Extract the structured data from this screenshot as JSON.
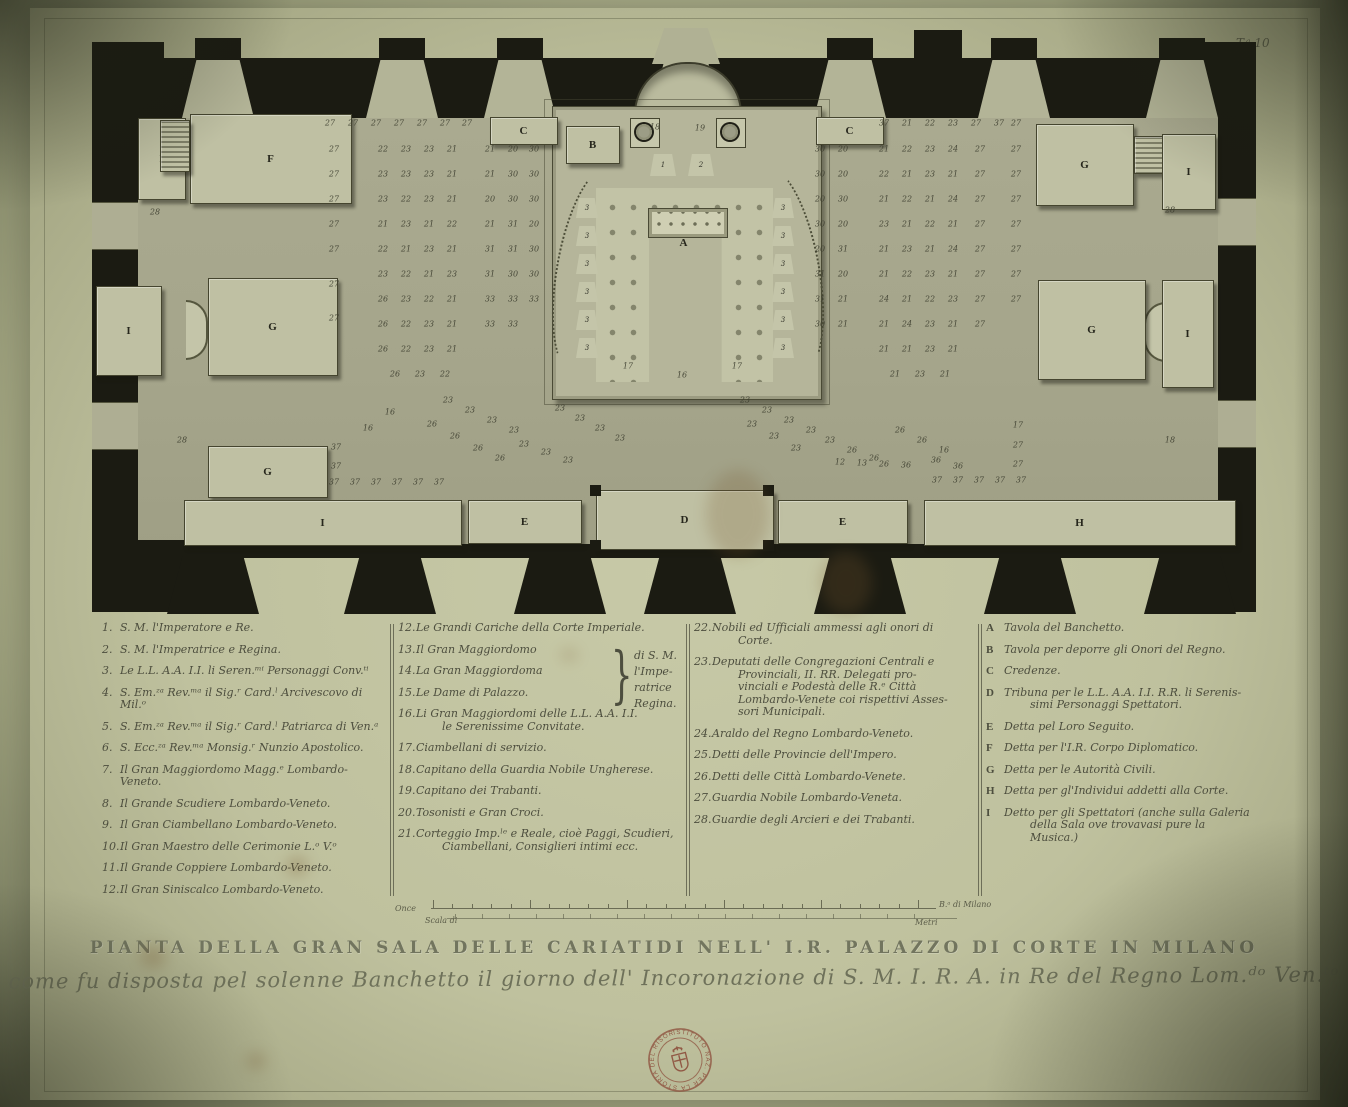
{
  "plate_number": "T.ᵃ 10",
  "title": "PIANTA DELLA GRAN SALA DELLE CARIATIDI NELL' I.R. PALAZZO DI CORTE IN MILANO",
  "subtitle": "come fu disposta pel solenne Banchetto il giorno dell' Incoronazione di S. M. I. R. A. in Re del Regno Lom.ᵈᵒ Ven.ᵗᵒ",
  "stamp": {
    "ring_text": "ISTITUTO NAZ. PER LA STORIA DEL RISORGIMENTO · ROMA ·",
    "color": "#8d4f3c"
  },
  "scale_bar": {
    "label_once": "Once",
    "label_scala": "Scala di",
    "label_braccia": "B.ᵃ di Milano",
    "label_metri": "Metri",
    "ticks_upper": 26,
    "ticks_lower": 18
  },
  "legend": {
    "columns": [
      {
        "x": 0,
        "width": 284,
        "items": [
          {
            "k": "1.",
            "t": "S. M. l'Imperatore e Re."
          },
          {
            "k": "2.",
            "t": "S. M. l'Imperatrice e Regina."
          },
          {
            "k": "3.",
            "t": "Le L.L. A.A. I.I. li Seren.ᵐⁱ Personaggi Conv.ᵗⁱ"
          },
          {
            "k": "4.",
            "t": "S. Em.ᶻᵃ Rev.ᵐᵃ il Sig.ʳ Card.ˡ Arcivescovo di Mil.ᵒ"
          },
          {
            "k": "5.",
            "t": "S. Em.ᶻᵃ Rev.ᵐᵃ il Sig.ʳ Card.ˡ Patriarca di Ven.ᵃ"
          },
          {
            "k": "6.",
            "t": "S. Ecc.ᶻᵃ Rev.ᵐᵃ Monsig.ʳ Nunzio Apostolico."
          },
          {
            "k": "7.",
            "t": "Il Gran Maggiordomo Magg.ᵉ Lombardo-Veneto."
          },
          {
            "k": "8.",
            "t": "Il Grande Scudiere Lombardo-Veneto."
          },
          {
            "k": "9.",
            "t": "Il Gran Ciambellano Lombardo-Veneto."
          },
          {
            "k": "10.",
            "t": "Il Gran Maestro delle Cerimonie L.ᵒ V.ᵒ"
          },
          {
            "k": "11.",
            "t": "Il Grande Coppiere Lombardo-Veneto."
          },
          {
            "k": "12.",
            "t": "Il Gran Siniscalco Lombardo-Veneto."
          }
        ]
      },
      {
        "x": 296,
        "width": 282,
        "brace": {
          "glyph": "}",
          "x": 204,
          "y": 16,
          "note_x": 236,
          "note_y": 26,
          "note_lines": [
            "di S. M. l'Impe-",
            "ratrice Regina."
          ]
        },
        "items": [
          {
            "k": "12.",
            "t": "Le Grandi Cariche della Corte Imperiale."
          },
          {
            "k": "13.",
            "t": "Il Gran Maggiordomo"
          },
          {
            "k": "14.",
            "t": "La Gran Maggiordoma"
          },
          {
            "k": "15.",
            "t": "Le Dame di Palazzo."
          },
          {
            "k": "16.",
            "t": "Li Gran Maggiordomi delle L.L. A.A. I.I.\nle Serenissime Convitate."
          },
          {
            "k": "17.",
            "t": "Ciambellani di servizio."
          },
          {
            "k": "18.",
            "t": "Capitano della Guardia Nobile Ungherese."
          },
          {
            "k": "19.",
            "t": "Capitano dei Trabanti."
          },
          {
            "k": "20.",
            "t": "Tosonisti e Gran Croci."
          },
          {
            "k": "21.",
            "t": "Corteggio Imp.ˡᵉ e Reale, cioè Paggi, Scudieri,\nCiambellani, Consiglieri intimi ecc."
          }
        ]
      },
      {
        "x": 592,
        "width": 282,
        "items": [
          {
            "k": "22.",
            "t": "Nobili ed Ufficiali ammessi agli onori di\nCorte."
          },
          {
            "k": "23.",
            "t": "Deputati delle Congregazioni Centrali e\nProvinciali, II. RR. Delegati pro-\nvinciali e Podestà delle R.ᵉ Città\nLombardo-Venete coi rispettivi Asses-\nsori Municipali."
          },
          {
            "k": "24.",
            "t": "Araldo del Regno Lombardo-Veneto."
          },
          {
            "k": "25.",
            "t": "Detti delle Provincie dell'Impero."
          },
          {
            "k": "26.",
            "t": "Detti delle Città Lombardo-Venete."
          },
          {
            "k": "27.",
            "t": "Guardia Nobile Lombardo-Veneta."
          },
          {
            "k": "28.",
            "t": "Guardie degli Arcieri e dei Trabanti."
          }
        ]
      },
      {
        "x": 884,
        "width": 280,
        "letters": true,
        "items": [
          {
            "k": "A",
            "t": "Tavola del Banchetto."
          },
          {
            "k": "B",
            "t": "Tavola per deporre gli Onori del Regno."
          },
          {
            "k": "C",
            "t": "Credenze."
          },
          {
            "k": "D",
            "t": "Tribuna per le L.L. A.A. I.I. R.R. li Serenis-\nsimi Personaggi Spettatori."
          },
          {
            "k": "E",
            "t": "Detta pel Loro Seguito."
          },
          {
            "k": "F",
            "t": "Detta per l'I.R. Corpo Diplomatico."
          },
          {
            "k": "G",
            "t": "Detta per le Autorità Civili."
          },
          {
            "k": "H",
            "t": "Detta per gl'Individui addetti alla Corte."
          },
          {
            "k": "I",
            "t": "Detto per gli Spettatori (anche sulla Galeria\ndella Sala ove trovavasi pure la\nMusica.)"
          }
        ]
      }
    ],
    "separators_x": [
      288,
      584,
      876
    ]
  },
  "plan": {
    "letters": [
      {
        "ch": "A",
        "x": 684,
        "y": 243
      }
    ],
    "platforms": [
      {
        "x": 138,
        "y": 118,
        "w": 46,
        "h": 80,
        "label": "I"
      },
      {
        "x": 190,
        "y": 114,
        "w": 160,
        "h": 88,
        "label": "F"
      },
      {
        "x": 160,
        "y": 120,
        "w": 28,
        "h": 50,
        "label": "",
        "hatch": true
      },
      {
        "x": 490,
        "y": 117,
        "w": 66,
        "h": 26,
        "label": "C"
      },
      {
        "x": 816,
        "y": 117,
        "w": 66,
        "h": 26,
        "label": "C"
      },
      {
        "x": 566,
        "y": 126,
        "w": 52,
        "h": 36,
        "label": "B"
      },
      {
        "x": 1036,
        "y": 124,
        "w": 96,
        "h": 80,
        "label": "G"
      },
      {
        "x": 1134,
        "y": 136,
        "w": 28,
        "h": 36,
        "label": "",
        "hatch": true
      },
      {
        "x": 1162,
        "y": 134,
        "w": 52,
        "h": 74,
        "label": "I"
      },
      {
        "x": 96,
        "y": 286,
        "w": 64,
        "h": 88,
        "label": "I"
      },
      {
        "x": 208,
        "y": 278,
        "w": 128,
        "h": 96,
        "label": "G"
      },
      {
        "x": 1038,
        "y": 280,
        "w": 106,
        "h": 98,
        "label": "G"
      },
      {
        "x": 1162,
        "y": 280,
        "w": 50,
        "h": 106,
        "label": "I"
      },
      {
        "x": 208,
        "y": 446,
        "w": 118,
        "h": 50,
        "label": "G"
      },
      {
        "x": 184,
        "y": 500,
        "w": 276,
        "h": 44,
        "label": "I"
      },
      {
        "x": 468,
        "y": 500,
        "w": 112,
        "h": 42,
        "label": "E"
      },
      {
        "x": 596,
        "y": 490,
        "w": 176,
        "h": 58,
        "label": "D"
      },
      {
        "x": 778,
        "y": 500,
        "w": 128,
        "h": 42,
        "label": "E"
      },
      {
        "x": 924,
        "y": 500,
        "w": 310,
        "h": 44,
        "label": "H"
      }
    ],
    "thrones": [
      {
        "x": 650,
        "y": 154,
        "v": "1"
      },
      {
        "x": 688,
        "y": 154,
        "v": "2"
      }
    ],
    "stools": {
      "left_x": 576,
      "right_x": 772,
      "ys": [
        198,
        226,
        254,
        282,
        310,
        338
      ],
      "label": "3"
    },
    "braziers": [
      {
        "x": 630,
        "y": 118
      },
      {
        "x": 716,
        "y": 118
      }
    ],
    "bays_top": [
      218,
      402,
      520,
      686,
      850,
      1014,
      1182
    ],
    "bays_bottom": [
      213,
      390,
      560,
      690,
      860,
      1030,
      1190
    ],
    "tall_block": {
      "x": 914,
      "y": 30,
      "w": 48,
      "h": 30
    },
    "number_rows": [
      {
        "y": 123,
        "xs": [
          330,
          353,
          376,
          399,
          422,
          445,
          467
        ],
        "vs": [
          "27",
          "27",
          "27",
          "27",
          "27",
          "27",
          "27"
        ]
      },
      {
        "y": 149,
        "xs": [
          383,
          406,
          429,
          452,
          490,
          513,
          534
        ],
        "vs": [
          "22",
          "23",
          "23",
          "21",
          "21",
          "20",
          "30"
        ]
      },
      {
        "y": 174,
        "xs": [
          383,
          406,
          429,
          452,
          490,
          513,
          534
        ],
        "vs": [
          "23",
          "23",
          "23",
          "21",
          "21",
          "30",
          "30"
        ]
      },
      {
        "y": 199,
        "xs": [
          383,
          406,
          429,
          452,
          490,
          513,
          534
        ],
        "vs": [
          "23",
          "22",
          "23",
          "21",
          "20",
          "30",
          "30"
        ]
      },
      {
        "y": 224,
        "xs": [
          383,
          406,
          429,
          452,
          490,
          513,
          534
        ],
        "vs": [
          "21",
          "23",
          "21",
          "22",
          "21",
          "31",
          "20"
        ]
      },
      {
        "y": 249,
        "xs": [
          383,
          406,
          429,
          452,
          490,
          513,
          534
        ],
        "vs": [
          "22",
          "21",
          "23",
          "21",
          "31",
          "31",
          "30"
        ]
      },
      {
        "y": 274,
        "xs": [
          383,
          406,
          429,
          452,
          490,
          513,
          534
        ],
        "vs": [
          "23",
          "22",
          "21",
          "23",
          "31",
          "30",
          "30"
        ]
      },
      {
        "y": 299,
        "xs": [
          383,
          406,
          429,
          452,
          490,
          513,
          534
        ],
        "vs": [
          "26",
          "23",
          "22",
          "21",
          "33",
          "33",
          "33"
        ]
      },
      {
        "y": 324,
        "xs": [
          383,
          406,
          429,
          452,
          490,
          513
        ],
        "vs": [
          "26",
          "22",
          "23",
          "21",
          "33",
          "33"
        ]
      },
      {
        "y": 349,
        "xs": [
          383,
          406,
          429,
          452
        ],
        "vs": [
          "26",
          "22",
          "23",
          "21"
        ]
      },
      {
        "y": 374,
        "xs": [
          395,
          420,
          445
        ],
        "vs": [
          "26",
          "23",
          "22"
        ]
      },
      {
        "y": 123,
        "xs": [
          884,
          907,
          930,
          953,
          976,
          999,
          1016
        ],
        "vs": [
          "37",
          "21",
          "22",
          "23",
          "27",
          "37",
          "27"
        ]
      },
      {
        "y": 149,
        "xs": [
          820,
          843,
          884,
          907,
          930,
          953,
          980,
          1016
        ],
        "vs": [
          "30",
          "20",
          "21",
          "22",
          "23",
          "24",
          "27",
          "27"
        ]
      },
      {
        "y": 174,
        "xs": [
          820,
          843,
          884,
          907,
          930,
          953,
          980,
          1016
        ],
        "vs": [
          "30",
          "20",
          "22",
          "21",
          "23",
          "21",
          "27",
          "27"
        ]
      },
      {
        "y": 199,
        "xs": [
          820,
          843,
          884,
          907,
          930,
          953,
          980,
          1016
        ],
        "vs": [
          "20",
          "30",
          "21",
          "22",
          "21",
          "24",
          "27",
          "27"
        ]
      },
      {
        "y": 224,
        "xs": [
          820,
          843,
          884,
          907,
          930,
          953,
          980,
          1016
        ],
        "vs": [
          "30",
          "20",
          "23",
          "21",
          "22",
          "21",
          "27",
          "27"
        ]
      },
      {
        "y": 249,
        "xs": [
          820,
          843,
          884,
          907,
          930,
          953,
          980,
          1016
        ],
        "vs": [
          "20",
          "31",
          "21",
          "23",
          "21",
          "24",
          "27",
          "27"
        ]
      },
      {
        "y": 274,
        "xs": [
          820,
          843,
          884,
          907,
          930,
          953,
          980,
          1016
        ],
        "vs": [
          "31",
          "20",
          "21",
          "22",
          "23",
          "21",
          "27",
          "27"
        ]
      },
      {
        "y": 299,
        "xs": [
          820,
          843,
          884,
          907,
          930,
          953,
          980,
          1016
        ],
        "vs": [
          "31",
          "21",
          "24",
          "21",
          "22",
          "23",
          "27",
          "27"
        ]
      },
      {
        "y": 324,
        "xs": [
          820,
          843,
          884,
          907,
          930,
          953,
          980
        ],
        "vs": [
          "30",
          "21",
          "21",
          "24",
          "23",
          "21",
          "27"
        ]
      },
      {
        "y": 349,
        "xs": [
          884,
          907,
          930,
          953
        ],
        "vs": [
          "21",
          "21",
          "23",
          "21"
        ]
      },
      {
        "y": 374,
        "xs": [
          895,
          920,
          945
        ],
        "vs": [
          "21",
          "23",
          "21"
        ]
      }
    ],
    "number_singles": [
      [
        334,
        149,
        "27"
      ],
      [
        334,
        174,
        "27"
      ],
      [
        334,
        199,
        "27"
      ],
      [
        334,
        224,
        "27"
      ],
      [
        334,
        249,
        "27"
      ],
      [
        334,
        284,
        "27"
      ],
      [
        334,
        318,
        "27"
      ],
      [
        448,
        400,
        "23"
      ],
      [
        470,
        410,
        "23"
      ],
      [
        492,
        420,
        "23"
      ],
      [
        514,
        430,
        "23"
      ],
      [
        560,
        408,
        "23"
      ],
      [
        580,
        418,
        "23"
      ],
      [
        600,
        428,
        "23"
      ],
      [
        620,
        438,
        "23"
      ],
      [
        432,
        424,
        "26"
      ],
      [
        455,
        436,
        "26"
      ],
      [
        478,
        448,
        "26"
      ],
      [
        500,
        458,
        "26"
      ],
      [
        524,
        444,
        "23"
      ],
      [
        546,
        452,
        "23"
      ],
      [
        568,
        460,
        "23"
      ],
      [
        390,
        412,
        "16"
      ],
      [
        368,
        428,
        "16"
      ],
      [
        182,
        440,
        "28"
      ],
      [
        155,
        212,
        "28"
      ],
      [
        336,
        447,
        "37"
      ],
      [
        336,
        466,
        "37"
      ],
      [
        334,
        482,
        "37"
      ],
      [
        355,
        482,
        "37"
      ],
      [
        376,
        482,
        "37"
      ],
      [
        397,
        482,
        "37"
      ],
      [
        418,
        482,
        "37"
      ],
      [
        439,
        482,
        "37"
      ],
      [
        745,
        400,
        "23"
      ],
      [
        767,
        410,
        "23"
      ],
      [
        789,
        420,
        "23"
      ],
      [
        811,
        430,
        "23"
      ],
      [
        752,
        424,
        "23"
      ],
      [
        774,
        436,
        "23"
      ],
      [
        796,
        448,
        "23"
      ],
      [
        830,
        440,
        "23"
      ],
      [
        852,
        450,
        "26"
      ],
      [
        874,
        458,
        "26"
      ],
      [
        900,
        430,
        "26"
      ],
      [
        922,
        440,
        "26"
      ],
      [
        944,
        450,
        "16"
      ],
      [
        840,
        462,
        "12"
      ],
      [
        862,
        463,
        "13"
      ],
      [
        884,
        464,
        "26"
      ],
      [
        906,
        465,
        "36"
      ],
      [
        936,
        460,
        "36"
      ],
      [
        958,
        466,
        "36"
      ],
      [
        937,
        480,
        "37"
      ],
      [
        958,
        480,
        "37"
      ],
      [
        979,
        480,
        "37"
      ],
      [
        1000,
        480,
        "37"
      ],
      [
        1021,
        480,
        "37"
      ],
      [
        1018,
        425,
        "17"
      ],
      [
        1018,
        445,
        "27"
      ],
      [
        1018,
        464,
        "27"
      ],
      [
        1170,
        210,
        "28"
      ],
      [
        1170,
        440,
        "18"
      ],
      [
        655,
        127,
        "18"
      ],
      [
        700,
        128,
        "19"
      ],
      [
        628,
        366,
        "17"
      ],
      [
        737,
        366,
        "17"
      ],
      [
        682,
        375,
        "16"
      ]
    ]
  }
}
